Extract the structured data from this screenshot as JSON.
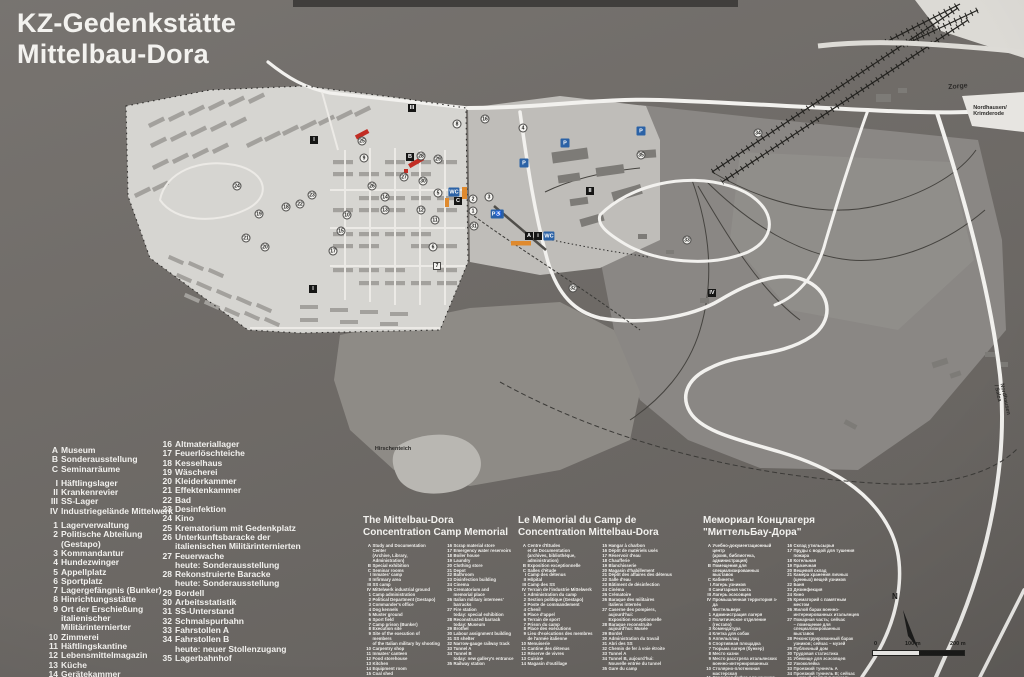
{
  "title": {
    "line1": "KZ-Gedenkstätte",
    "line2": "Mittelbau-Dora"
  },
  "legend_de": {
    "col1_groups": [
      [
        {
          "k": "A",
          "t": "Museum"
        },
        {
          "k": "B",
          "t": "Sonderausstellung"
        },
        {
          "k": "C",
          "t": "Seminarräume"
        }
      ],
      [
        {
          "k": "I",
          "t": "Häftlingslager"
        },
        {
          "k": "II",
          "t": "Krankenrevier"
        },
        {
          "k": "III",
          "t": "SS-Lager"
        },
        {
          "k": "IV",
          "t": "Industriegelände Mittelwerk"
        }
      ],
      [
        {
          "k": "1",
          "t": "Lagerverwaltung"
        },
        {
          "k": "2",
          "t": "Politische Abteilung (Gestapo)"
        },
        {
          "k": "3",
          "t": "Kommandantur"
        },
        {
          "k": "4",
          "t": "Hundezwinger"
        },
        {
          "k": "5",
          "t": "Appellplatz"
        },
        {
          "k": "6",
          "t": "Sportplatz"
        },
        {
          "k": "7",
          "t": "Lagergefängnis (Bunker)"
        },
        {
          "k": "8",
          "t": "Hinrichtungsstätte"
        },
        {
          "k": "9",
          "t": "Ort der Erschießung\nitalienischer Militärinternierter"
        },
        {
          "k": "10",
          "t": "Zimmerei"
        },
        {
          "k": "11",
          "t": "Häftlingskantine"
        },
        {
          "k": "12",
          "t": "Lebensmittelmagazin"
        },
        {
          "k": "13",
          "t": "Küche"
        },
        {
          "k": "14",
          "t": "Gerätekammer"
        },
        {
          "k": "15",
          "t": "Kohlenschuppen"
        }
      ]
    ],
    "col2_groups": [
      [
        {
          "k": "16",
          "t": "Altmateriallager"
        },
        {
          "k": "17",
          "t": "Feuerlöschteiche"
        },
        {
          "k": "18",
          "t": "Kesselhaus"
        },
        {
          "k": "19",
          "t": "Wäscherei"
        },
        {
          "k": "20",
          "t": "Kleiderkammer"
        },
        {
          "k": "21",
          "t": "Effektenkammer"
        },
        {
          "k": "22",
          "t": "Bad"
        },
        {
          "k": "23",
          "t": "Desinfektion"
        },
        {
          "k": "24",
          "t": "Kino"
        },
        {
          "k": "25",
          "t": "Krematorium mit Gedenkplatz"
        },
        {
          "k": "26",
          "t": "Unterkunftsbaracke der\nitalienischen Militärinternierten"
        },
        {
          "k": "27",
          "t": "Feuerwache\nheute: Sonderausstellung"
        },
        {
          "k": "28",
          "t": "Rekonstruierte Baracke\nheute: Sonderausstellung"
        },
        {
          "k": "29",
          "t": "Bordell"
        },
        {
          "k": "30",
          "t": "Arbeitsstatistik"
        },
        {
          "k": "31",
          "t": "SS-Unterstand"
        },
        {
          "k": "32",
          "t": "Schmalspurbahn"
        },
        {
          "k": "33",
          "t": "Fahrstollen A"
        },
        {
          "k": "34",
          "t": "Fahrstollen B\nheute: neuer Stollenzugang"
        },
        {
          "k": "35",
          "t": "Lagerbahnhof"
        }
      ]
    ]
  },
  "translations": [
    {
      "id": "en",
      "x": 363,
      "title": "The Mittelbau-Dora\nConcentration Camp Memorial",
      "col1": [
        {
          "k": "A",
          "t": "Study and Documentation Center\n(Archive, Library, Administration)"
        },
        {
          "k": "B",
          "t": "Special exhibition"
        },
        {
          "k": "C",
          "t": "Seminar rooms"
        },
        {
          "k": "I",
          "t": "Inmates' camp"
        },
        {
          "k": "II",
          "t": "Infirmary area"
        },
        {
          "k": "III",
          "t": "SS camp"
        },
        {
          "k": "IV",
          "t": "Mittelwerk industrial ground"
        },
        {
          "k": "1",
          "t": "Camp administration"
        },
        {
          "k": "2",
          "t": "Political Department (Gestapo)"
        },
        {
          "k": "3",
          "t": "Commander's office"
        },
        {
          "k": "4",
          "t": "Dog kennels"
        },
        {
          "k": "5",
          "t": "Muster ground"
        },
        {
          "k": "6",
          "t": "Sport field"
        },
        {
          "k": "7",
          "t": "Camp prison (Bunker)"
        },
        {
          "k": "8",
          "t": "Execution site"
        },
        {
          "k": "9",
          "t": "Site of the execution of members\nof the Italian military by shooting"
        },
        {
          "k": "10",
          "t": "Carpentry shop"
        },
        {
          "k": "11",
          "t": "Inmates' canteen"
        },
        {
          "k": "12",
          "t": "Food storehouse"
        },
        {
          "k": "13",
          "t": "Kitchen"
        },
        {
          "k": "14",
          "t": "Equipment room"
        },
        {
          "k": "15",
          "t": "Coal shed"
        }
      ],
      "col2": [
        {
          "k": "16",
          "t": "Scrap material store"
        },
        {
          "k": "17",
          "t": "Emergency water reservoirs"
        },
        {
          "k": "18",
          "t": "Boiler house"
        },
        {
          "k": "19",
          "t": "Laundry"
        },
        {
          "k": "20",
          "t": "Clothing store"
        },
        {
          "k": "21",
          "t": "Depot"
        },
        {
          "k": "22",
          "t": "Bathroom"
        },
        {
          "k": "23",
          "t": "Disinfection building"
        },
        {
          "k": "24",
          "t": "Cinema"
        },
        {
          "k": "25",
          "t": "Crematorium and\nmemorial place"
        },
        {
          "k": "26",
          "t": "Italian military internees'\nbarracks"
        },
        {
          "k": "27",
          "t": "Fire station\ntoday: special exhibition"
        },
        {
          "k": "28",
          "t": "Reconstructed barrack\ntoday: Museum"
        },
        {
          "k": "29",
          "t": "Brothel"
        },
        {
          "k": "30",
          "t": "Labour assignment building"
        },
        {
          "k": "31",
          "t": "SS shelter"
        },
        {
          "k": "32",
          "t": "Narrow-gauge railway track"
        },
        {
          "k": "33",
          "t": "Tunnel A"
        },
        {
          "k": "34",
          "t": "Tunnel B\ntoday: new gallery's entrance"
        },
        {
          "k": "35",
          "t": "Railway station"
        }
      ]
    },
    {
      "id": "fr",
      "x": 518,
      "title": "Le Memorial du Camp de\nConcentration Mittelbau-Dora",
      "col1": [
        {
          "k": "A",
          "t": "Centre d'Études\net de Documentation\n(archives, bibliothèque, administration)"
        },
        {
          "k": "B",
          "t": "Exposition exceptionnelle"
        },
        {
          "k": "C",
          "t": "Salles d'étude"
        },
        {
          "k": "I",
          "t": "Camp des détenus"
        },
        {
          "k": "II",
          "t": "Hôpital"
        },
        {
          "k": "III",
          "t": "Camp des SS"
        },
        {
          "k": "IV",
          "t": "Terrain de l'industrie Mittelwerk"
        },
        {
          "k": "1",
          "t": "Administration du camp"
        },
        {
          "k": "2",
          "t": "Section politique (Gestapo)"
        },
        {
          "k": "3",
          "t": "Poste de commandement"
        },
        {
          "k": "4",
          "t": "Chenil"
        },
        {
          "k": "5",
          "t": "Place d'appel"
        },
        {
          "k": "6",
          "t": "Terrain de sport"
        },
        {
          "k": "7",
          "t": "Prison du camp"
        },
        {
          "k": "8",
          "t": "Place des exécutions"
        },
        {
          "k": "9",
          "t": "Lieu d'exécutions des membres\nde l'armée italienne"
        },
        {
          "k": "10",
          "t": "Menuiserie"
        },
        {
          "k": "11",
          "t": "Cantine des détenus"
        },
        {
          "k": "12",
          "t": "Réserve de vivres"
        },
        {
          "k": "13",
          "t": "Cuisine"
        },
        {
          "k": "14",
          "t": "Magasin d'outillage"
        }
      ],
      "col2": [
        {
          "k": "15",
          "t": "Hangar à charbon"
        },
        {
          "k": "16",
          "t": "Dépôt de matériels usés"
        },
        {
          "k": "17",
          "t": "Réservoir d'eau"
        },
        {
          "k": "18",
          "t": "Chaufferie"
        },
        {
          "k": "19",
          "t": "Blanchisserie"
        },
        {
          "k": "20",
          "t": "Magasin d'habillement"
        },
        {
          "k": "21",
          "t": "Dépôt des affaires des détenus"
        },
        {
          "k": "22",
          "t": "Salle d'eau"
        },
        {
          "k": "23",
          "t": "Bâtiment de désinfection"
        },
        {
          "k": "24",
          "t": "Cinéma"
        },
        {
          "k": "25",
          "t": "Crématoire"
        },
        {
          "k": "26",
          "t": "Baraque des militaires\nitaliens internés"
        },
        {
          "k": "27",
          "t": "Caserne des pompiers, aujourd'hui:\nExposition exceptionnelle"
        },
        {
          "k": "28",
          "t": "Baraque reconstruite\naujourd'hui: Musée"
        },
        {
          "k": "29",
          "t": "Bordel"
        },
        {
          "k": "30",
          "t": "Administration du travail"
        },
        {
          "k": "31",
          "t": "Abri des SS"
        },
        {
          "k": "32",
          "t": "Chemin de fer à voie étroite"
        },
        {
          "k": "33",
          "t": "Tunnel A"
        },
        {
          "k": "34",
          "t": "Tunnel B, aujourd'hui:\nNouvelle entrée du tunnel"
        },
        {
          "k": "35",
          "t": "Gare du camp"
        }
      ]
    },
    {
      "id": "ru",
      "x": 703,
      "title": "Мемориал Концлагеря\n\"МиттельБау-Дора\"",
      "col1": [
        {
          "k": "A",
          "t": "Учебно-документационный центр\n(архив, библиотека, администрация)"
        },
        {
          "k": "B",
          "t": "Помещения для\nспециализированных выставок"
        },
        {
          "k": "C",
          "t": "Кабинеты"
        },
        {
          "k": "I",
          "t": "Лагерь узников"
        },
        {
          "k": "II",
          "t": "Санитарная часть"
        },
        {
          "k": "III",
          "t": "Лагерь эсэсовцев"
        },
        {
          "k": "IV",
          "t": "Промышленная территория з-да\nМиттельверк"
        },
        {
          "k": "1",
          "t": "Администрация лагеря"
        },
        {
          "k": "2",
          "t": "Политическое отделение (гестапо)"
        },
        {
          "k": "3",
          "t": "Комендатура"
        },
        {
          "k": "4",
          "t": "Клетка для собак"
        },
        {
          "k": "5",
          "t": "Аппельплац"
        },
        {
          "k": "6",
          "t": "Спортивная площадка"
        },
        {
          "k": "7",
          "t": "Тюрьма лагеря (бункер)"
        },
        {
          "k": "8",
          "t": "Место казни"
        },
        {
          "k": "9",
          "t": "Место расстрела итальянских\nвоенно-интернированных"
        },
        {
          "k": "10",
          "t": "Столярно-плотничная мастерская"
        },
        {
          "k": "11",
          "t": "Столовая-буфет для узников"
        },
        {
          "k": "12",
          "t": "Продовольственный магазин"
        },
        {
          "k": "13",
          "t": "Кухня"
        },
        {
          "k": "14",
          "t": "Склад утвари"
        },
        {
          "k": "15",
          "t": "Угольный склад"
        }
      ],
      "col2": [
        {
          "k": "16",
          "t": "Склад утильсырья"
        },
        {
          "k": "17",
          "t": "Пруды с водой для тушения\nпожара"
        },
        {
          "k": "18",
          "t": "Котельная"
        },
        {
          "k": "19",
          "t": "Прачечная"
        },
        {
          "k": "20",
          "t": "Вещевой склад"
        },
        {
          "k": "21",
          "t": "Камера хранения личных\n(ценных) вещей узников"
        },
        {
          "k": "22",
          "t": "Баня"
        },
        {
          "k": "23",
          "t": "Дезинфекция"
        },
        {
          "k": "24",
          "t": "Кино"
        },
        {
          "k": "25",
          "t": "Крематорий с памятным\nместом"
        },
        {
          "k": "26",
          "t": "Жилой барак военно-\nинтернированных итальянцев"
        },
        {
          "k": "27",
          "t": "Пожарная часть; сейчас\n– помещение для\nспециализированных выставок"
        },
        {
          "k": "28",
          "t": "Реконструированный барак\nузников; сейчас – музей"
        },
        {
          "k": "29",
          "t": "Публичный дом"
        },
        {
          "k": "30",
          "t": "Трудовая статистика"
        },
        {
          "k": "31",
          "t": "Убежище для эсэсовцев"
        },
        {
          "k": "32",
          "t": "Узкоколейка"
        },
        {
          "k": "33",
          "t": "Проезжий туннель А"
        },
        {
          "k": "34",
          "t": "Проезжий туннель В; сейчас\n– новый доступ в туннель"
        },
        {
          "k": "35",
          "t": "Вокзал лагеря"
        }
      ]
    }
  ],
  "map_labels": [
    {
      "t": "Zorge",
      "x": 958,
      "y": 87,
      "r": -5,
      "s": 7
    },
    {
      "t": "Nordhausen/\nKrimderode",
      "x": 990,
      "y": 112,
      "r": 0,
      "s": 5.5
    },
    {
      "t": "Hirschenteich",
      "x": 393,
      "y": 450,
      "r": 0,
      "s": 5.5
    },
    {
      "t": "Nordhausen / Salza",
      "x": 1001,
      "y": 400,
      "r": 78,
      "s": 5.5
    }
  ],
  "map_markers": [
    {
      "t": "c",
      "l": "25",
      "x": 362,
      "y": 141
    },
    {
      "t": "c",
      "l": "9",
      "x": 364,
      "y": 158
    },
    {
      "t": "c",
      "l": "28",
      "x": 421,
      "y": 156
    },
    {
      "t": "c",
      "l": "27",
      "x": 404,
      "y": 177
    },
    {
      "t": "c",
      "l": "30",
      "x": 423,
      "y": 181
    },
    {
      "t": "c",
      "l": "26",
      "x": 372,
      "y": 186
    },
    {
      "t": "c",
      "l": "14",
      "x": 385,
      "y": 197
    },
    {
      "t": "c",
      "l": "13",
      "x": 385,
      "y": 210
    },
    {
      "t": "c",
      "l": "12",
      "x": 421,
      "y": 210
    },
    {
      "t": "c",
      "l": "11",
      "x": 435,
      "y": 220
    },
    {
      "t": "c",
      "l": "10",
      "x": 347,
      "y": 215
    },
    {
      "t": "c",
      "l": "23",
      "x": 312,
      "y": 195
    },
    {
      "t": "c",
      "l": "22",
      "x": 300,
      "y": 204
    },
    {
      "t": "c",
      "l": "18",
      "x": 286,
      "y": 207
    },
    {
      "t": "c",
      "l": "19",
      "x": 259,
      "y": 214
    },
    {
      "t": "c",
      "l": "21",
      "x": 246,
      "y": 238
    },
    {
      "t": "c",
      "l": "20",
      "x": 265,
      "y": 247
    },
    {
      "t": "c",
      "l": "17",
      "x": 333,
      "y": 251
    },
    {
      "t": "c",
      "l": "24",
      "x": 237,
      "y": 186
    },
    {
      "t": "c",
      "l": "15",
      "x": 341,
      "y": 231
    },
    {
      "t": "c",
      "l": "6",
      "x": 433,
      "y": 247
    },
    {
      "t": "c",
      "l": "29",
      "x": 438,
      "y": 159
    },
    {
      "t": "c",
      "l": "5",
      "x": 438,
      "y": 193
    },
    {
      "t": "c",
      "l": "2",
      "x": 473,
      "y": 199
    },
    {
      "t": "c",
      "l": "3",
      "x": 489,
      "y": 197
    },
    {
      "t": "c",
      "l": "1",
      "x": 473,
      "y": 211
    },
    {
      "t": "c",
      "l": "31",
      "x": 474,
      "y": 226
    },
    {
      "t": "c",
      "l": "4",
      "x": 523,
      "y": 128
    },
    {
      "t": "c",
      "l": "8",
      "x": 457,
      "y": 124
    },
    {
      "t": "c",
      "l": "16",
      "x": 485,
      "y": 119
    },
    {
      "t": "c",
      "l": "32",
      "x": 573,
      "y": 288
    },
    {
      "t": "c",
      "l": "33",
      "x": 687,
      "y": 240
    },
    {
      "t": "c",
      "l": "34",
      "x": 758,
      "y": 133
    },
    {
      "t": "c",
      "l": "35",
      "x": 641,
      "y": 155
    },
    {
      "t": "sq",
      "l": "7",
      "x": 437,
      "y": 266
    },
    {
      "t": "bb",
      "l": "B",
      "x": 410,
      "y": 157
    },
    {
      "t": "bb",
      "l": "C",
      "x": 458,
      "y": 201
    },
    {
      "t": "bb",
      "l": "A",
      "x": 529,
      "y": 236
    },
    {
      "t": "bb",
      "l": "i",
      "x": 538,
      "y": 236
    },
    {
      "t": "bb",
      "l": "I",
      "x": 314,
      "y": 140
    },
    {
      "t": "bb",
      "l": "I",
      "x": 313,
      "y": 289
    },
    {
      "t": "bb",
      "l": "II",
      "x": 590,
      "y": 191
    },
    {
      "t": "bb",
      "l": "III",
      "x": 412,
      "y": 108
    },
    {
      "t": "bb",
      "l": "IV",
      "x": 712,
      "y": 293
    },
    {
      "t": "bl",
      "l": "P",
      "x": 565,
      "y": 143
    },
    {
      "t": "bl",
      "l": "P",
      "x": 524,
      "y": 163
    },
    {
      "t": "bl",
      "l": "P",
      "x": 641,
      "y": 131
    },
    {
      "t": "bl",
      "l": "P♿",
      "x": 497,
      "y": 214
    },
    {
      "t": "bl",
      "l": "WC",
      "x": 454,
      "y": 192
    },
    {
      "t": "bl",
      "l": "WC",
      "x": 549,
      "y": 236
    }
  ],
  "scale_bar": {
    "start": "0",
    "mid": "100 m",
    "end": "200 m"
  },
  "compass_label": "N",
  "colors": {
    "board": "#6f6b67",
    "camp_area": "#d6d5d1",
    "roads": "#f2f1ee",
    "marker_blue": "#2b62a6",
    "highlight_red": "#c22d24",
    "highlight_orange": "#df8a2e"
  }
}
